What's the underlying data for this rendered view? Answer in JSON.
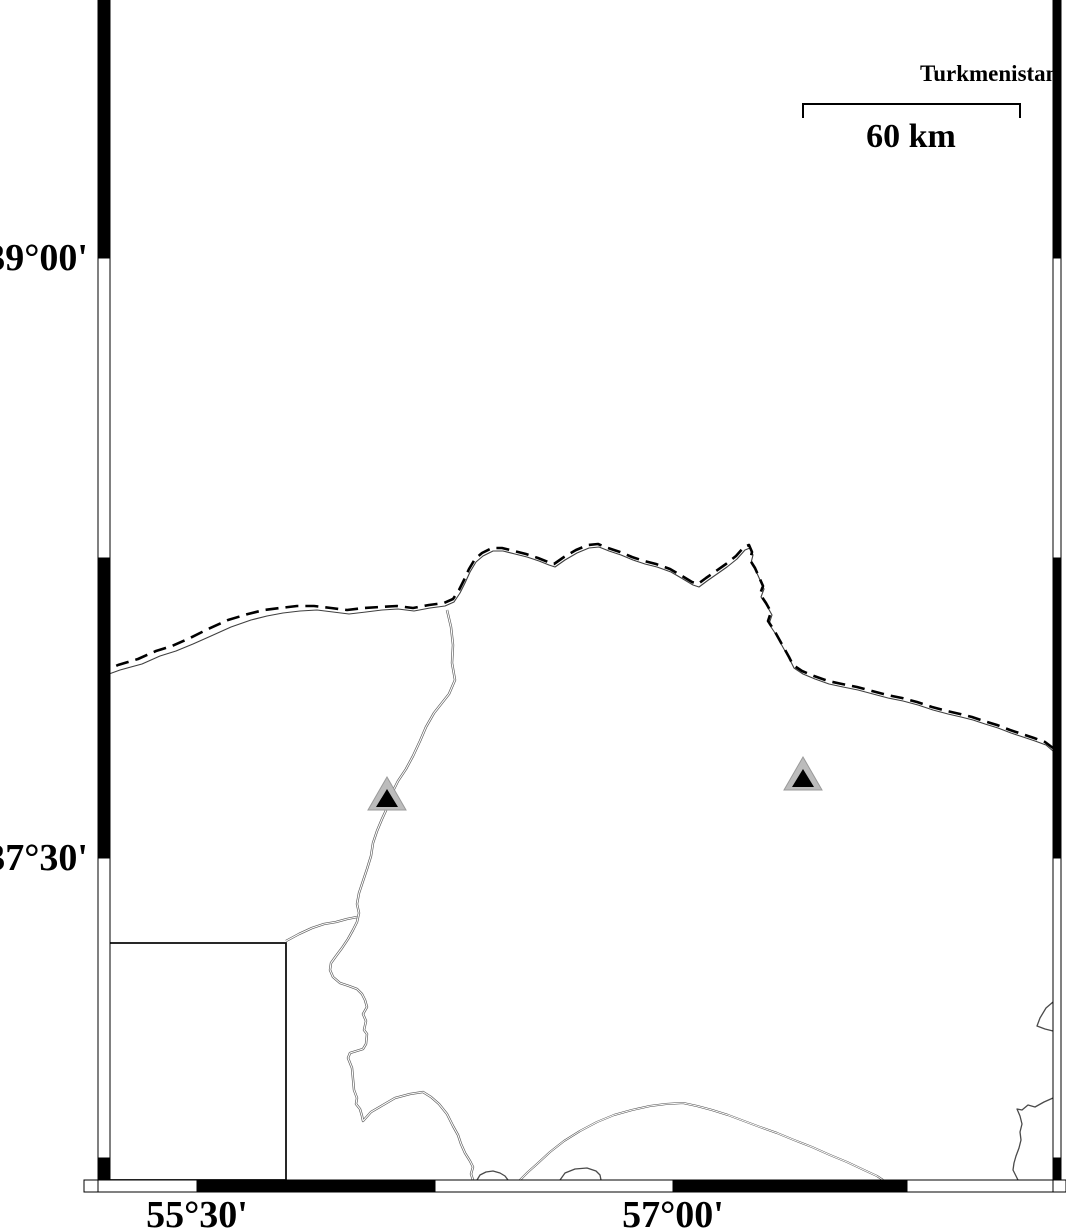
{
  "map": {
    "axis_labels": {
      "lat": [
        {
          "text": "39°00'",
          "y": 258
        },
        {
          "text": "37°30'",
          "y": 858
        }
      ],
      "lon": [
        {
          "text": "55°30'",
          "x": 197
        },
        {
          "text": "57°00'",
          "x": 673
        }
      ]
    },
    "annotations": {
      "country_label": "Turkmenistan",
      "scale_label": "60 km"
    },
    "colors": {
      "frame_black": "#000000",
      "frame_white": "#ffffff",
      "line_dark": "#3f3f3f",
      "line_mid": "#555555",
      "border_dash": "#000000",
      "marker_outer": "#bcbcbc",
      "marker_outer_edge": "#9a9a9a",
      "marker_inner": "#000000"
    },
    "scale_bar": {
      "x1": 803,
      "x2": 1020,
      "y": 104,
      "tick_drop": 14,
      "label_x_center": 911,
      "label_top": 120
    },
    "country_label_pos": {
      "x": 920,
      "y": 62
    },
    "frame": {
      "bands": [
        {
          "name": "frame-left-band",
          "orient": "v",
          "x": 98,
          "w": 12,
          "segs": [
            [
              0,
              258,
              "k"
            ],
            [
              258,
              558,
              "w"
            ],
            [
              558,
              858,
              "k"
            ],
            [
              858,
              1158,
              "w"
            ],
            [
              1158,
              1180,
              "k"
            ]
          ]
        },
        {
          "name": "frame-right-band",
          "orient": "v",
          "x": 1053,
          "w": 8,
          "segs": [
            [
              0,
              258,
              "k"
            ],
            [
              258,
              558,
              "w"
            ],
            [
              558,
              858,
              "k"
            ],
            [
              858,
              1158,
              "w"
            ],
            [
              1158,
              1180,
              "k"
            ]
          ]
        },
        {
          "name": "frame-bottom-band",
          "orient": "h",
          "y": 1180,
          "h": 12,
          "segs": [
            [
              84,
              98,
              "w"
            ],
            [
              98,
              197,
              "w"
            ],
            [
              197,
              435,
              "k"
            ],
            [
              435,
              673,
              "w"
            ],
            [
              673,
              907,
              "k"
            ],
            [
              907,
              1053,
              "w"
            ],
            [
              1053,
              1066,
              "w"
            ]
          ]
        }
      ]
    },
    "inset_box": {
      "x": 108,
      "y": 943,
      "w": 178,
      "h": 237
    },
    "markers": [
      {
        "name": "station-triangle-west",
        "outer": "387,777 368,810 406,810",
        "inner": "387,789 376,807 398,807"
      },
      {
        "name": "station-triangle-east",
        "outer": "803,757 784,790 822,790",
        "inner": "803,769 792,787 814,787"
      }
    ],
    "paths": [
      {
        "name": "border-companion-line",
        "stroke": "#3f3f3f",
        "width": 1.1,
        "d": "M98,678 L120,670 L142,664 L160,656 L176,651 L193,644 L211,636 L231,627 L251,620 L267,616 L283,613 L300,611 L317,610 L333,612 L349,614 L366,612 L382,610 L398,609 L414,611 L430,608 L445,606 L454,602 L460,593 L465,583 L470,572 L476,562 L483,556 L493,551 L503,551 L515,554 L527,557 L539,561 L549,565 L555,567 L565,560 L577,553 L589,548 L599,547 L609,551 L621,555 L633,560 L645,564 L657,567 L671,572 L683,579 L693,585 L699,587 L707,581 L717,574 L727,567 L737,559 L745,550 L750,548 L753,555 L751,563 L756,571 L760,580 L764,589 L761,597 L767,606 L772,615 L769,624 L775,633 L780,642 L785,651 L790,660 L794,668 L803,674 L815,679 L829,684 L843,687 L858,690 L873,694 L888,698 L903,701 L918,705 L933,710 L948,714 L961,717 L973,720 L985,724 L998,728 L1011,733 L1023,737 L1035,741 L1046,745 L1053,751"
      },
      {
        "name": "country-border-dashed",
        "stroke": "#000000",
        "width": 2.6,
        "dash": "13 7",
        "d": "M98,674 L118,665 L138,659 L156,651 L172,646 L190,638 L208,629 L228,620 L248,614 L264,610 L280,608 L297,606 L314,606 L331,608 L347,610 L364,608 L380,607 L397,606 L413,608 L429,605 L444,603 L453,599 L459,590 L464,580 L469,569 L475,559 L482,553 L492,548 L502,548 L514,551 L526,554 L538,558 L548,562 L554,564 L564,557 L576,550 L588,545 L598,544 L608,548 L620,552 L632,557 L644,561 L656,564 L670,569 L682,576 L692,582 L698,584 L706,578 L716,571 L726,564 L736,556 L744,547 L749,545 L752,552 L750,560 L755,568 L759,577 L763,586 L760,594 L766,603 L771,612 L768,621 L774,630 L779,639 L784,648 L789,657 L793,665 L802,671 L814,676 L828,681 L842,684 L857,687 L872,691 L887,695 L902,698 L917,702 L932,707 L947,711 L960,714 L972,717 L984,721 L997,725 L1010,730 L1022,734 L1034,738 L1045,742 L1053,748"
      },
      {
        "name": "river-main",
        "stroke": "#5a5a5a",
        "width": 2.4,
        "double": true,
        "d": "M447,610 L451,627 L453,645 L452,663 L455,680 L449,694 L434,713 L426,727 L420,741 L413,756 L406,769 L398,781 L392,793 L388,806 L382,819 L377,831 L373,843 L371,856 L367,869 L363,881 L359,893 L357,904 L359,913 L357,922 L353,930 L348,939 L342,948 L336,956 L331,963 L330,970 L333,977 L340,983 L349,986 L357,989 L362,994 L365,1000 L367,1007 L363,1014 L366,1021 L364,1030 L367,1034 L366,1044 L363,1049 L350,1053 L348,1058 L352,1068 L353,1079 L354,1090 L357,1098 L356,1104 L360,1109 L362,1116 L363,1121 L371,1112 L383,1105 L395,1098 L410,1094 L423,1092 L431,1097 L439,1104 L447,1114 L453,1126 L458,1135 L461,1144 L465,1153 L470,1161 L473,1167 L471,1174 L473,1180"
      },
      {
        "name": "river-from-inset",
        "stroke": "#5a5a5a",
        "width": 2.4,
        "double": true,
        "d": "M286,941 L299,934 L312,928 L324,924 L336,922 L347,919 L357,917"
      },
      {
        "name": "coast-arc",
        "stroke": "#4a4a4a",
        "width": 2.0,
        "double": true,
        "d": "M520,1180 L528,1172 L537,1164 L550,1152 L564,1141 L580,1131 L597,1122 L614,1115 L632,1110 L650,1106 L666,1104 L683,1103 L697,1106 L712,1110 L728,1115 L744,1121 L760,1127 L777,1133 L794,1140 L812,1147 L830,1155 L847,1162 L864,1170 L877,1176 L883,1180"
      },
      {
        "name": "coast-hump",
        "stroke": "#4a4a4a",
        "width": 1.3,
        "d": "M477,1180 L480,1175 L486,1172 L493,1171 L500,1173 L505,1176 L508,1180"
      },
      {
        "name": "coast-blob",
        "stroke": "#4a4a4a",
        "width": 1.3,
        "d": "M560,1180 L565,1173 L575,1169 L587,1168 L596,1171 L600,1175 L601,1180"
      },
      {
        "name": "right-edge-notch",
        "stroke": "#4a4a4a",
        "width": 1.3,
        "d": "M1053,1002 L1046,1008 L1040,1018 L1037,1026 L1045,1029 L1053,1031"
      },
      {
        "name": "right-edge-line",
        "stroke": "#4a4a4a",
        "width": 1.3,
        "d": "M1053,1098 L1044,1102 L1035,1107 L1028,1105 L1022,1110 L1017,1109 L1020,1116 L1022,1124 L1020,1132 L1021,1140 L1019,1148 L1016,1156 L1014,1163 L1013,1170 L1016,1176 L1018,1180"
      }
    ]
  }
}
